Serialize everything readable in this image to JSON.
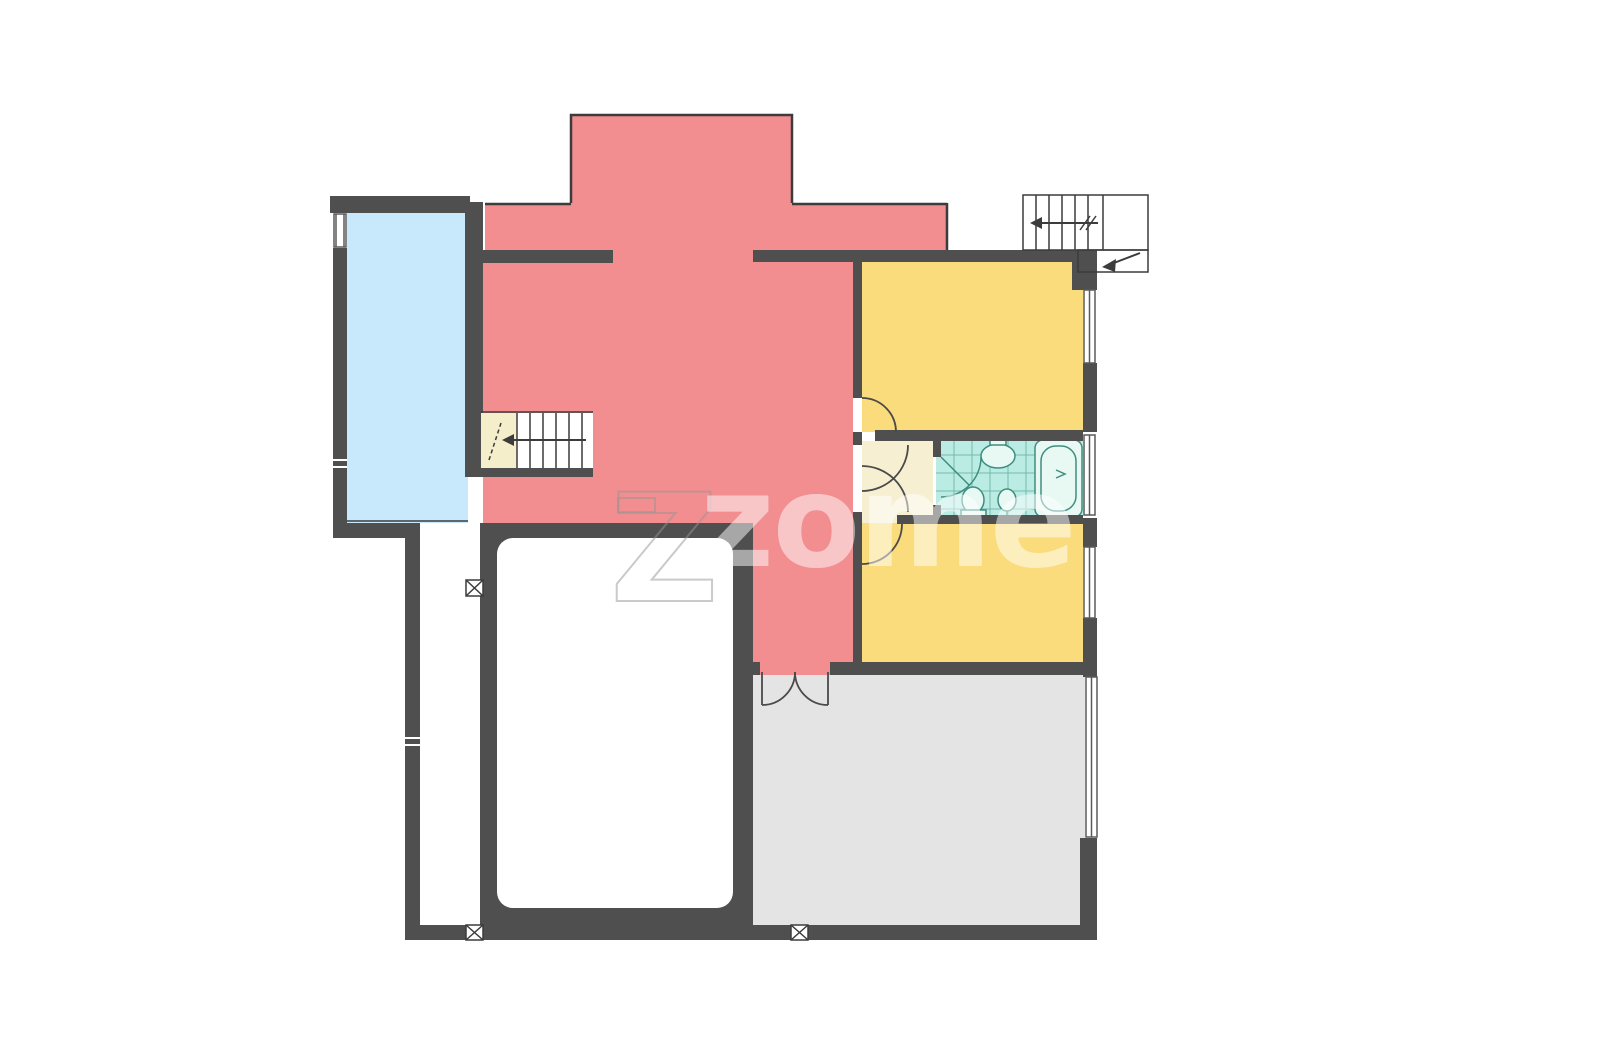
{
  "image": {
    "type": "architectural-floor-plan",
    "watermark": {
      "text": "zome",
      "big_letter": "Z"
    }
  },
  "palette": {
    "wall": "#4f4f4f",
    "line": "#3c3c3c",
    "door_line": "#4a4a4a",
    "room_red": "#f28d90",
    "room_yellow": "#fbdc7d",
    "room_blue": "#c7e9fb",
    "room_gray": "#e4e4e4",
    "hall_cream": "#f6efd2",
    "stair_landing": "#f5eecb",
    "bath_teal": "#baece3",
    "bath_line": "#3f8d80",
    "fixture_fill": "#e8f9f4",
    "white": "#ffffff",
    "window_line": "#5a5a5a",
    "watermark_fill": "rgba(255,255,255,0.5)",
    "watermark_stroke": "rgba(150,150,150,0.5)"
  }
}
